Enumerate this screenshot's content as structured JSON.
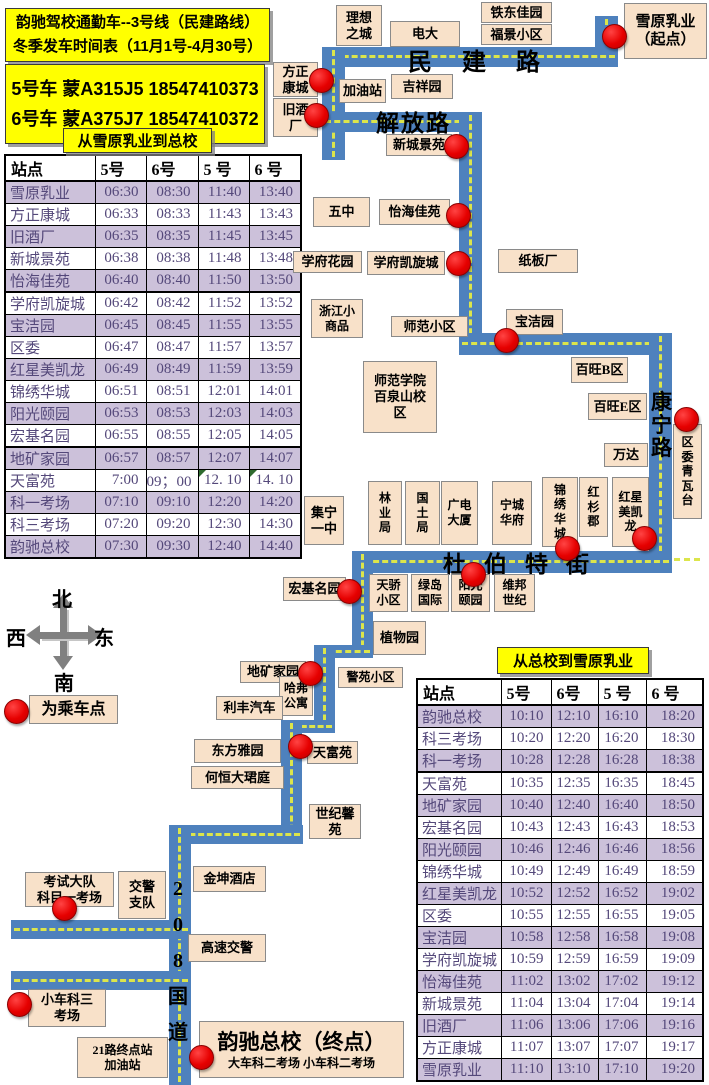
{
  "title": {
    "line1": "韵驰驾校通勤车--3号线（民建路线）",
    "line2": "冬季发车时间表（11月1号-4月30号）"
  },
  "bus_info": {
    "line1": "5号车 蒙A315J5 18547410373",
    "line2": "6号车 蒙A375J7 18547410372"
  },
  "legend": {
    "label": "为乘车点"
  },
  "compass": {
    "north": "北",
    "south": "南",
    "west": "西",
    "east": "东"
  },
  "colors": {
    "route_blue": "#4E81BD",
    "route_dash_yellow": "#DCE54B",
    "label_box_fill": "#F8E1C9",
    "stop_dot_red": "#E60000",
    "table_alt_row": "#CCC1DA",
    "table_text_purple": "#54487A",
    "title_yellow": "#FFFF00"
  },
  "tables": [
    {
      "name": "outbound-timetable",
      "title": "从雪原乳业到总校",
      "x": 4,
      "y": 154,
      "w": 296,
      "h": 378,
      "col_widths": [
        90,
        51,
        52,
        51,
        52
      ],
      "headers": [
        "站点",
        "5号",
        "6号",
        "5 号",
        "6 号"
      ],
      "rows": [
        [
          "雪原乳业",
          "06:30",
          "08:30",
          "11:40",
          "13:40"
        ],
        [
          "方正康城",
          "06:33",
          "08:33",
          "11:43",
          "13:43"
        ],
        [
          "旧酒厂",
          "06:35",
          "08:35",
          "11:45",
          "13:45"
        ],
        [
          "新城景苑",
          "06:38",
          "08:38",
          "11:48",
          "13:48"
        ],
        [
          "怡海佳苑",
          "06:40",
          "08:40",
          "11:50",
          "13:50"
        ],
        [
          "学府凯旋城",
          "06:42",
          "08:42",
          "11:52",
          "13:52"
        ],
        [
          "宝洁园",
          "06:45",
          "08:45",
          "11:55",
          "13:55"
        ],
        [
          "区委",
          "06:47",
          "08:47",
          "11:57",
          "13:57"
        ],
        [
          "红星美凯龙",
          "06:49",
          "08:49",
          "11:59",
          "13:59"
        ],
        [
          "锦绣华城",
          "06:51",
          "08:51",
          "12:01",
          "14:01"
        ],
        [
          "阳光颐园",
          "06:53",
          "08:53",
          "12:03",
          "14:03"
        ],
        [
          "宏基名园",
          "06:55",
          "08:55",
          "12:05",
          "14:05"
        ],
        [
          "地矿家园",
          "06:57",
          "08:57",
          "12:07",
          "14:07"
        ],
        [
          "天富苑",
          "7:00",
          "09；00",
          "12. 10",
          "14. 10"
        ],
        [
          "科一考场",
          "07:10",
          "09:10",
          "12:20",
          "14:20"
        ],
        [
          "科三考场",
          "07:20",
          "09:20",
          "12:30",
          "14:30"
        ],
        [
          "韵驰总校",
          "07:30",
          "09:30",
          "12:40",
          "14:40"
        ]
      ],
      "green_corners": [
        [
          13,
          3
        ],
        [
          13,
          4
        ]
      ],
      "thick_after": [
        4,
        11
      ]
    },
    {
      "name": "inbound-timetable",
      "title": "从总校到雪原乳业",
      "x": 416,
      "y": 678,
      "w": 286,
      "h": 396,
      "col_widths": [
        84,
        50,
        47,
        48,
        57
      ],
      "headers": [
        "站点",
        "5号",
        "6号",
        "5 号",
        "6 号"
      ],
      "rows": [
        [
          "韵驰总校",
          "10:10",
          "12:10",
          "16:10",
          "18:20"
        ],
        [
          "科三考场",
          "10:20",
          "12:20",
          "16:20",
          "18:30"
        ],
        [
          "科一考场",
          "10:28",
          "12:28",
          "16:28",
          "18:38"
        ],
        [
          "天富苑",
          "10:35",
          "12:35",
          "16:35",
          "18:45"
        ],
        [
          "地矿家园",
          "10:40",
          "12:40",
          "16:40",
          "18:50"
        ],
        [
          "宏基名园",
          "10:43",
          "12:43",
          "16:43",
          "18:53"
        ],
        [
          "阳光颐园",
          "10:46",
          "12:46",
          "16:46",
          "18:56"
        ],
        [
          "锦绣华城",
          "10:49",
          "12:49",
          "16:49",
          "18:59"
        ],
        [
          "红星美凯龙",
          "10:52",
          "12:52",
          "16:52",
          "19:02"
        ],
        [
          "区委",
          "10:55",
          "12:55",
          "16:55",
          "19:05"
        ],
        [
          "宝洁园",
          "10:58",
          "12:58",
          "16:58",
          "19:08"
        ],
        [
          "学府凯旋城",
          "10:59",
          "12:59",
          "16:59",
          "19:09"
        ],
        [
          "怡海佳苑",
          "11:02",
          "13:02",
          "17:02",
          "19:12"
        ],
        [
          "新城景苑",
          "11:04",
          "13:04",
          "17:04",
          "19:14"
        ],
        [
          "旧酒厂",
          "11:06",
          "13:06",
          "17:06",
          "19:16"
        ],
        [
          "方正康城",
          "11:07",
          "13:07",
          "17:07",
          "19:17"
        ],
        [
          "雪原乳业",
          "11:10",
          "13:10",
          "17:10",
          "19:20"
        ]
      ],
      "green_corners": [],
      "thick_after": [
        2
      ]
    }
  ],
  "map": {
    "segments": [
      [
        595,
        16,
        23,
        51
      ],
      [
        322,
        47,
        296,
        20
      ],
      [
        322,
        47,
        23,
        113
      ],
      [
        322,
        112,
        160,
        20
      ],
      [
        459,
        112,
        23,
        243
      ],
      [
        459,
        333,
        213,
        22
      ],
      [
        649,
        333,
        23,
        240
      ],
      [
        352,
        551,
        320,
        22
      ],
      [
        352,
        551,
        21,
        107
      ],
      [
        314,
        645,
        59,
        13
      ],
      [
        314,
        645,
        21,
        88
      ],
      [
        281,
        720,
        54,
        13
      ],
      [
        281,
        720,
        21,
        123
      ],
      [
        169,
        825,
        134,
        19
      ],
      [
        169,
        825,
        22,
        260
      ],
      [
        11,
        920,
        180,
        19
      ],
      [
        11,
        971,
        180,
        19
      ]
    ],
    "roads": [
      {
        "t": "民建路",
        "x": 408,
        "y": 42,
        "fs": 24,
        "ls": 30
      },
      {
        "t": "解放路",
        "x": 376,
        "y": 104,
        "fs": 23,
        "ls": 2
      },
      {
        "t": "杜伯特街",
        "x": 443,
        "y": 545,
        "fs": 23,
        "ls": 18
      },
      {
        "t": "康\n宁\n路",
        "x": 651,
        "y": 391,
        "fs": 21,
        "lh": 23
      },
      {
        "t": "2\n0\n8\n国\n道",
        "x": 168,
        "y": 871,
        "fs": 20,
        "lh": 36
      }
    ],
    "boxes": [
      {
        "t": "理想\n之城",
        "x": 336,
        "y": 5,
        "w": 46,
        "h": 41
      },
      {
        "t": "电大",
        "x": 390,
        "y": 21,
        "w": 70,
        "h": 26
      },
      {
        "t": "铁东佳园",
        "x": 481,
        "y": 2,
        "w": 71,
        "h": 21
      },
      {
        "t": "福景小区",
        "x": 481,
        "y": 24,
        "w": 71,
        "h": 21
      },
      {
        "t": "雪原乳业\n（起点）",
        "x": 624,
        "y": 3,
        "w": 83,
        "h": 56,
        "fs": 15
      },
      {
        "t": "方正\n康城",
        "x": 273,
        "y": 62,
        "w": 45,
        "h": 35
      },
      {
        "t": "加油站",
        "x": 339,
        "y": 79,
        "w": 47,
        "h": 24
      },
      {
        "t": "吉祥园",
        "x": 391,
        "y": 74,
        "w": 62,
        "h": 25
      },
      {
        "t": "旧酒\n厂",
        "x": 273,
        "y": 98,
        "w": 45,
        "h": 39
      },
      {
        "t": "新城景苑",
        "x": 386,
        "y": 134,
        "w": 66,
        "h": 22
      },
      {
        "t": "五中",
        "x": 313,
        "y": 197,
        "w": 57,
        "h": 30
      },
      {
        "t": "怡海佳苑",
        "x": 379,
        "y": 199,
        "w": 71,
        "h": 26
      },
      {
        "t": "学府花园",
        "x": 293,
        "y": 251,
        "w": 69,
        "h": 22
      },
      {
        "t": "学府凯旋城",
        "x": 367,
        "y": 251,
        "w": 78,
        "h": 24
      },
      {
        "t": "纸板厂",
        "x": 498,
        "y": 249,
        "w": 80,
        "h": 24
      },
      {
        "t": "浙江小\n商品",
        "x": 311,
        "y": 299,
        "w": 52,
        "h": 39,
        "fs": 12
      },
      {
        "t": "师范小区",
        "x": 391,
        "y": 316,
        "w": 77,
        "h": 21
      },
      {
        "t": "宝洁园",
        "x": 506,
        "y": 309,
        "w": 57,
        "h": 26
      },
      {
        "t": "师范学院\n百泉山校\n区",
        "x": 363,
        "y": 361,
        "w": 74,
        "h": 72
      },
      {
        "t": "百旺B区",
        "x": 571,
        "y": 357,
        "w": 57,
        "h": 26
      },
      {
        "t": "百旺E区",
        "x": 588,
        "y": 393,
        "w": 59,
        "h": 27
      },
      {
        "t": "万达",
        "x": 604,
        "y": 443,
        "w": 44,
        "h": 24
      },
      {
        "t": "区\n委\n青\n瓦\n台",
        "x": 673,
        "y": 424,
        "w": 29,
        "h": 95,
        "fs": 12
      },
      {
        "t": "集宁\n一中",
        "x": 304,
        "y": 496,
        "w": 40,
        "h": 49
      },
      {
        "t": "林\n业\n局",
        "x": 368,
        "y": 481,
        "w": 34,
        "h": 64,
        "fs": 12
      },
      {
        "t": "国\n土\n局",
        "x": 405,
        "y": 481,
        "w": 35,
        "h": 64,
        "fs": 12
      },
      {
        "t": "广电\n大厦",
        "x": 441,
        "y": 481,
        "w": 37,
        "h": 64,
        "fs": 12
      },
      {
        "t": "宁城\n华府",
        "x": 492,
        "y": 481,
        "w": 40,
        "h": 64,
        "fs": 12
      },
      {
        "t": "锦\n绣\n华\n城",
        "x": 542,
        "y": 477,
        "w": 36,
        "h": 70,
        "fs": 12
      },
      {
        "t": "红\n杉\n郡",
        "x": 579,
        "y": 477,
        "w": 29,
        "h": 60,
        "fs": 12
      },
      {
        "t": "红星\n美凯\n龙",
        "x": 612,
        "y": 477,
        "w": 37,
        "h": 70,
        "fs": 12
      },
      {
        "t": "宏基名园",
        "x": 283,
        "y": 577,
        "w": 63,
        "h": 24
      },
      {
        "t": "天骄\n小区",
        "x": 369,
        "y": 574,
        "w": 39,
        "h": 38,
        "fs": 12
      },
      {
        "t": "绿岛\n国际",
        "x": 411,
        "y": 574,
        "w": 38,
        "h": 38,
        "fs": 12
      },
      {
        "t": "阳光\n颐园",
        "x": 451,
        "y": 574,
        "w": 39,
        "h": 38,
        "fs": 12
      },
      {
        "t": "维邦\n世纪",
        "x": 494,
        "y": 574,
        "w": 41,
        "h": 38,
        "fs": 12
      },
      {
        "t": "植物园",
        "x": 373,
        "y": 621,
        "w": 53,
        "h": 34
      },
      {
        "t": "警苑小区",
        "x": 338,
        "y": 667,
        "w": 65,
        "h": 21,
        "fs": 12
      },
      {
        "t": "地矿家园",
        "x": 240,
        "y": 661,
        "w": 66,
        "h": 22
      },
      {
        "t": "哈弗\n公寓",
        "x": 279,
        "y": 676,
        "w": 34,
        "h": 40,
        "fs": 12
      },
      {
        "t": "利丰汽车",
        "x": 216,
        "y": 696,
        "w": 67,
        "h": 24
      },
      {
        "t": "东方雅园",
        "x": 194,
        "y": 739,
        "w": 87,
        "h": 24
      },
      {
        "t": "何恒大珺庭",
        "x": 191,
        "y": 766,
        "w": 93,
        "h": 23
      },
      {
        "t": "天富苑",
        "x": 307,
        "y": 741,
        "w": 51,
        "h": 23
      },
      {
        "t": "世纪馨\n苑",
        "x": 309,
        "y": 804,
        "w": 52,
        "h": 35
      },
      {
        "t": "金坤酒店",
        "x": 193,
        "y": 866,
        "w": 73,
        "h": 26
      },
      {
        "t": "考试大队\n科目一考场",
        "x": 25,
        "y": 872,
        "w": 89,
        "h": 35
      },
      {
        "t": "交警\n支队",
        "x": 118,
        "y": 871,
        "w": 48,
        "h": 48
      },
      {
        "t": "高速交警",
        "x": 188,
        "y": 934,
        "w": 78,
        "h": 28
      },
      {
        "t": "小车科三\n考场",
        "x": 28,
        "y": 989,
        "w": 78,
        "h": 38
      },
      {
        "t": "21路终点站\n加油站",
        "x": 77,
        "y": 1037,
        "w": 91,
        "h": 41,
        "fs": 12
      }
    ],
    "terminal": {
      "title": "韵驰总校（终点）",
      "subtitle": "大车科二考场  小车科二考场"
    },
    "stops": [
      [
        613,
        35
      ],
      [
        320,
        79
      ],
      [
        315,
        114
      ],
      [
        455,
        145
      ],
      [
        457,
        214
      ],
      [
        457,
        262
      ],
      [
        505,
        339
      ],
      [
        685,
        418
      ],
      [
        643,
        537
      ],
      [
        566,
        547
      ],
      [
        472,
        573
      ],
      [
        348,
        590
      ],
      [
        309,
        672
      ],
      [
        299,
        745
      ],
      [
        63,
        907
      ],
      [
        18,
        1003
      ],
      [
        200,
        1056
      ]
    ]
  }
}
